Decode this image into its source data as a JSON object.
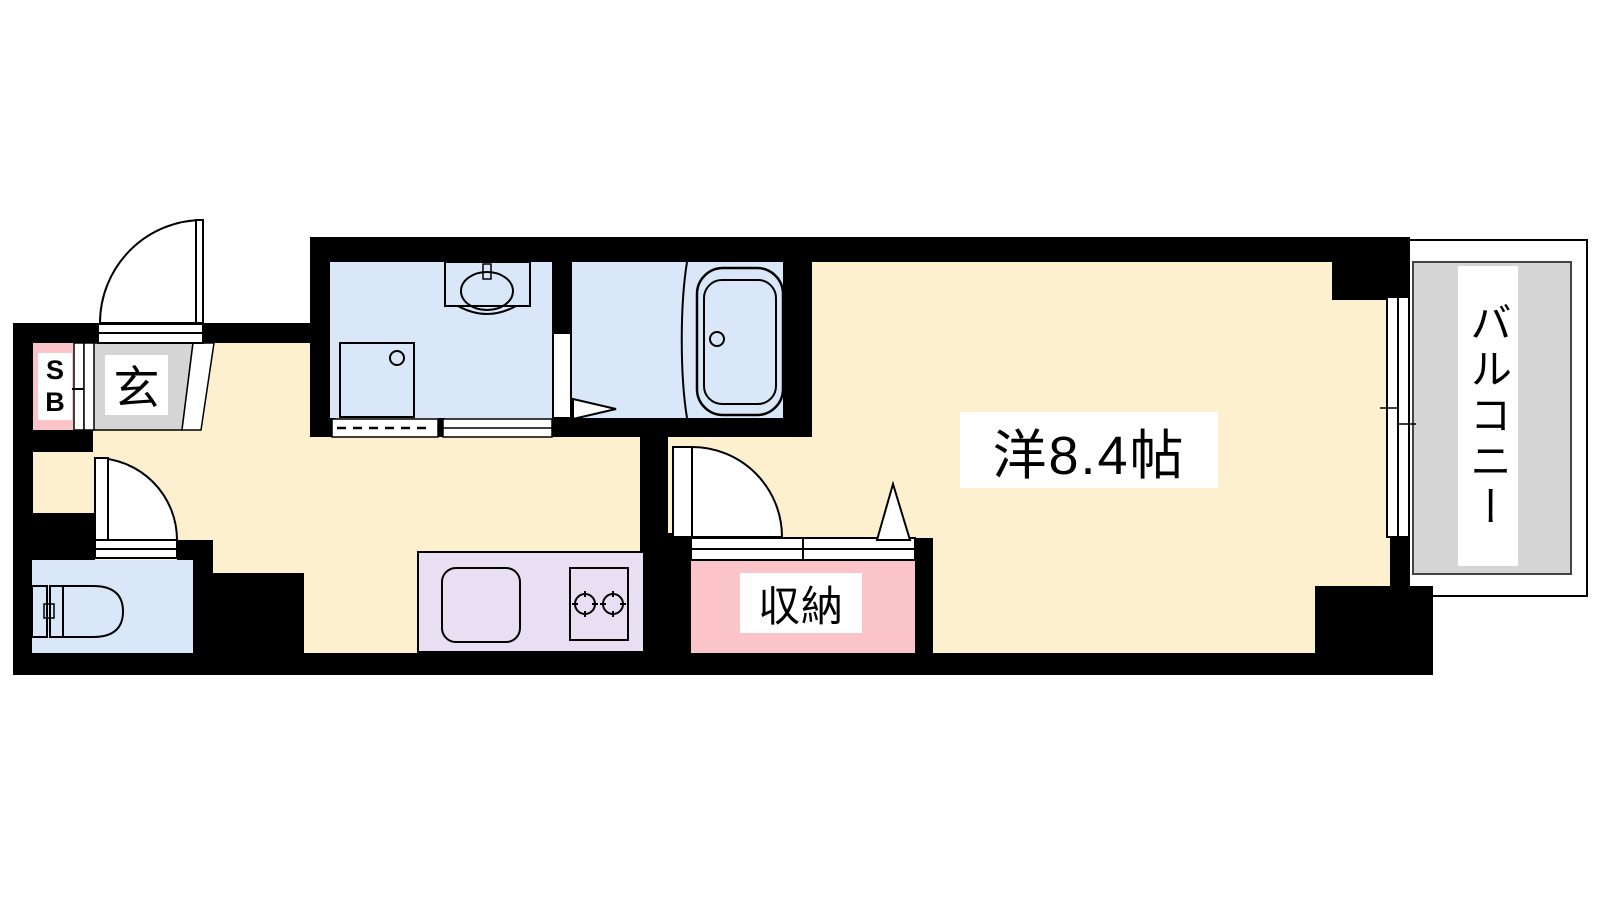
{
  "floorplan": {
    "title": "1R apartment floor plan",
    "labels": {
      "shoe_box_top": "S",
      "shoe_box_bottom": "B",
      "entrance": "玄",
      "storage": "収納",
      "western_room": "洋8.4帖",
      "balcony": "バルコニー"
    },
    "colors": {
      "floor_cream": "#fcf0cf",
      "wet_area_blue": "#d9e7f8",
      "storage_pink": "#fbc4c9",
      "kitchen_purple": "#e8dff2",
      "entrance_gray": "#d5d5d5",
      "balcony_gray": "#d5d5d5",
      "wall_black": "#000000"
    }
  }
}
